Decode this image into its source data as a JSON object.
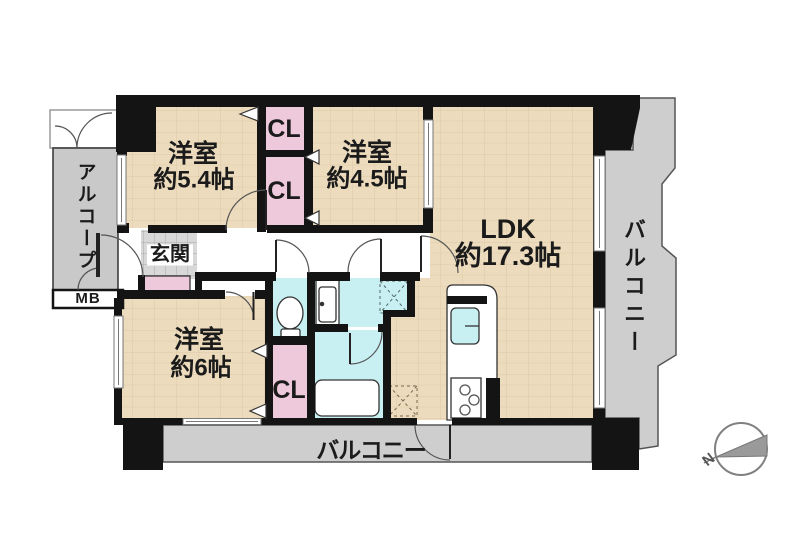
{
  "plan": {
    "rooms": {
      "bedroom_a": {
        "name": "洋室",
        "size": "約5.4帖"
      },
      "bedroom_b": {
        "name": "洋室",
        "size": "約4.5帖"
      },
      "bedroom_c": {
        "name": "洋室",
        "size": "約6帖"
      },
      "ldk": {
        "name": "LDK",
        "size": "約17.3帖"
      },
      "entrance": {
        "label": "玄関"
      },
      "closet_top": {
        "label": "CL"
      },
      "closet_mid": {
        "label": "CL"
      },
      "closet_bottom": {
        "label": "CL"
      },
      "alcove": {
        "label": "アルコープ"
      },
      "meter_box": {
        "label": "MB"
      },
      "balcony_side": {
        "label": "バルコニー"
      },
      "balcony_bottom": {
        "label": "バルコニー"
      }
    },
    "compass": {
      "north": "N"
    },
    "colors": {
      "floor": "#ecdbbd",
      "floor_grid": "#d9c4a0",
      "wall": "#141414",
      "closet_pink": "#eec9db",
      "wet_cyan": "#c8eff1",
      "balcony_gray": "#cecece",
      "alcove_gray": "#c9c9c9",
      "entrance_tile": "#d8d8d8"
    }
  }
}
